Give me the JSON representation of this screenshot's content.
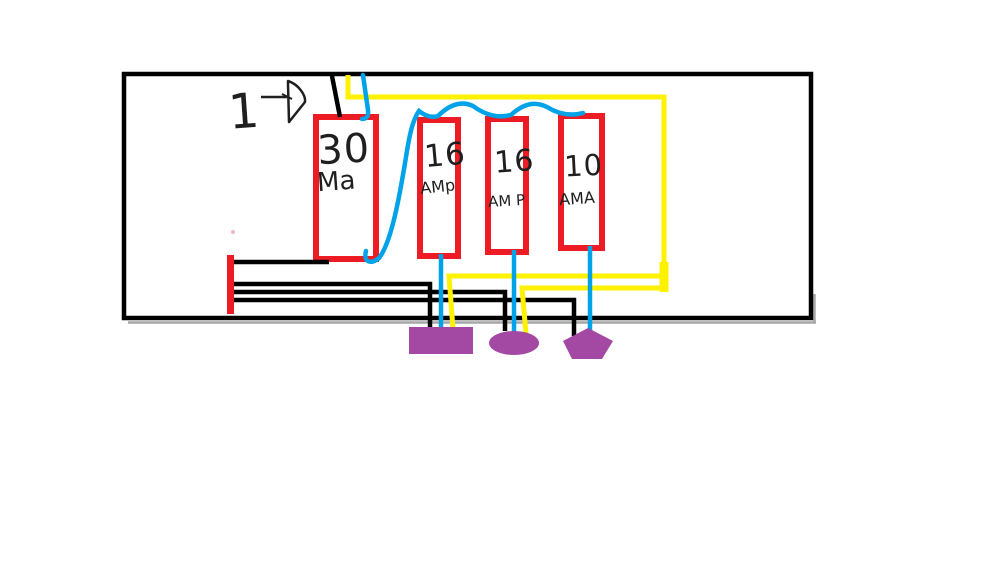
{
  "canvas": {
    "width": 1000,
    "height": 563,
    "background": "#ffffff"
  },
  "colors": {
    "outline": "#000000",
    "wire_black": "#000000",
    "wire_blue": "#00a2e8",
    "wire_yellow": "#fff200",
    "breaker_red": "#ed1c24",
    "bus_red": "#ed1c24",
    "load_purple": "#a349a4",
    "ink": "#1f1f1f",
    "shadow": "#a6a6a6",
    "speck_pink": "#f4b8c1"
  },
  "annotation": {
    "label": "1",
    "arrow_icon": "arrow-right-icon"
  },
  "breakers": [
    {
      "id": "breaker-1",
      "rating": "30",
      "unit": "Ma"
    },
    {
      "id": "breaker-2",
      "rating": "16",
      "unit": "AMp"
    },
    {
      "id": "breaker-3",
      "rating": "16",
      "unit": "AM P"
    },
    {
      "id": "breaker-4",
      "rating": "10",
      "unit": "AMA"
    }
  ],
  "loads": [
    {
      "shape": "rectangle"
    },
    {
      "shape": "ellipse"
    },
    {
      "shape": "pentagon"
    }
  ]
}
